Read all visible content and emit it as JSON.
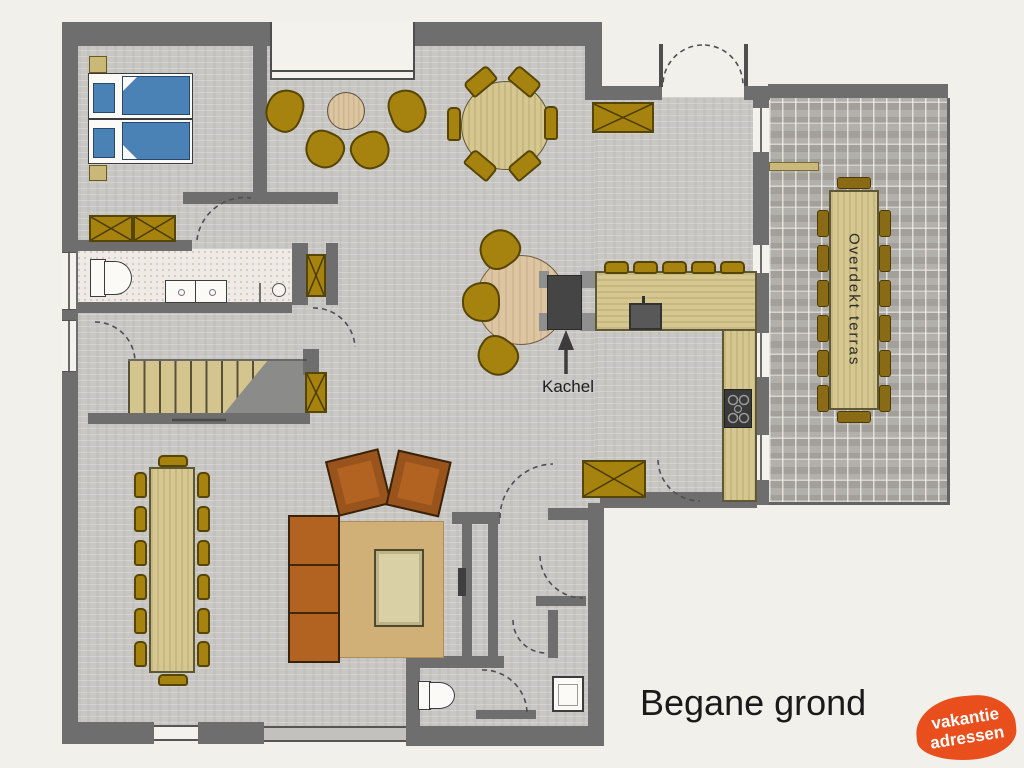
{
  "title": "Begane grond",
  "labels": {
    "kachel": "Kachel",
    "terrace": "Overdekt terras"
  },
  "logo": {
    "line1": "vakantie",
    "line2": "adressen"
  },
  "colors": {
    "exterior": "#f2f0ea",
    "floor": "#c8c7c4",
    "wall": "#6e6e6e",
    "gold": "#a5830e",
    "gold-border": "#574504",
    "pale-gold": "#c9b878",
    "wood": "#d5c78f",
    "wood-border": "#5f5835",
    "tan": "#dcc5a0",
    "rug": "#d1b077",
    "sofa": "#b26322",
    "sofa-border": "#38220a",
    "bed-blue": "#4a82b5",
    "bed-border": "#27476b",
    "terrace-chair": "#8a6b15",
    "stove": "#454545",
    "stove-cap": "#8f8f8f",
    "bath-floor": "#efeae5",
    "paving": "#aca9a4",
    "logo-orange": "#e94f1c",
    "ink": "#1a1a1a"
  }
}
